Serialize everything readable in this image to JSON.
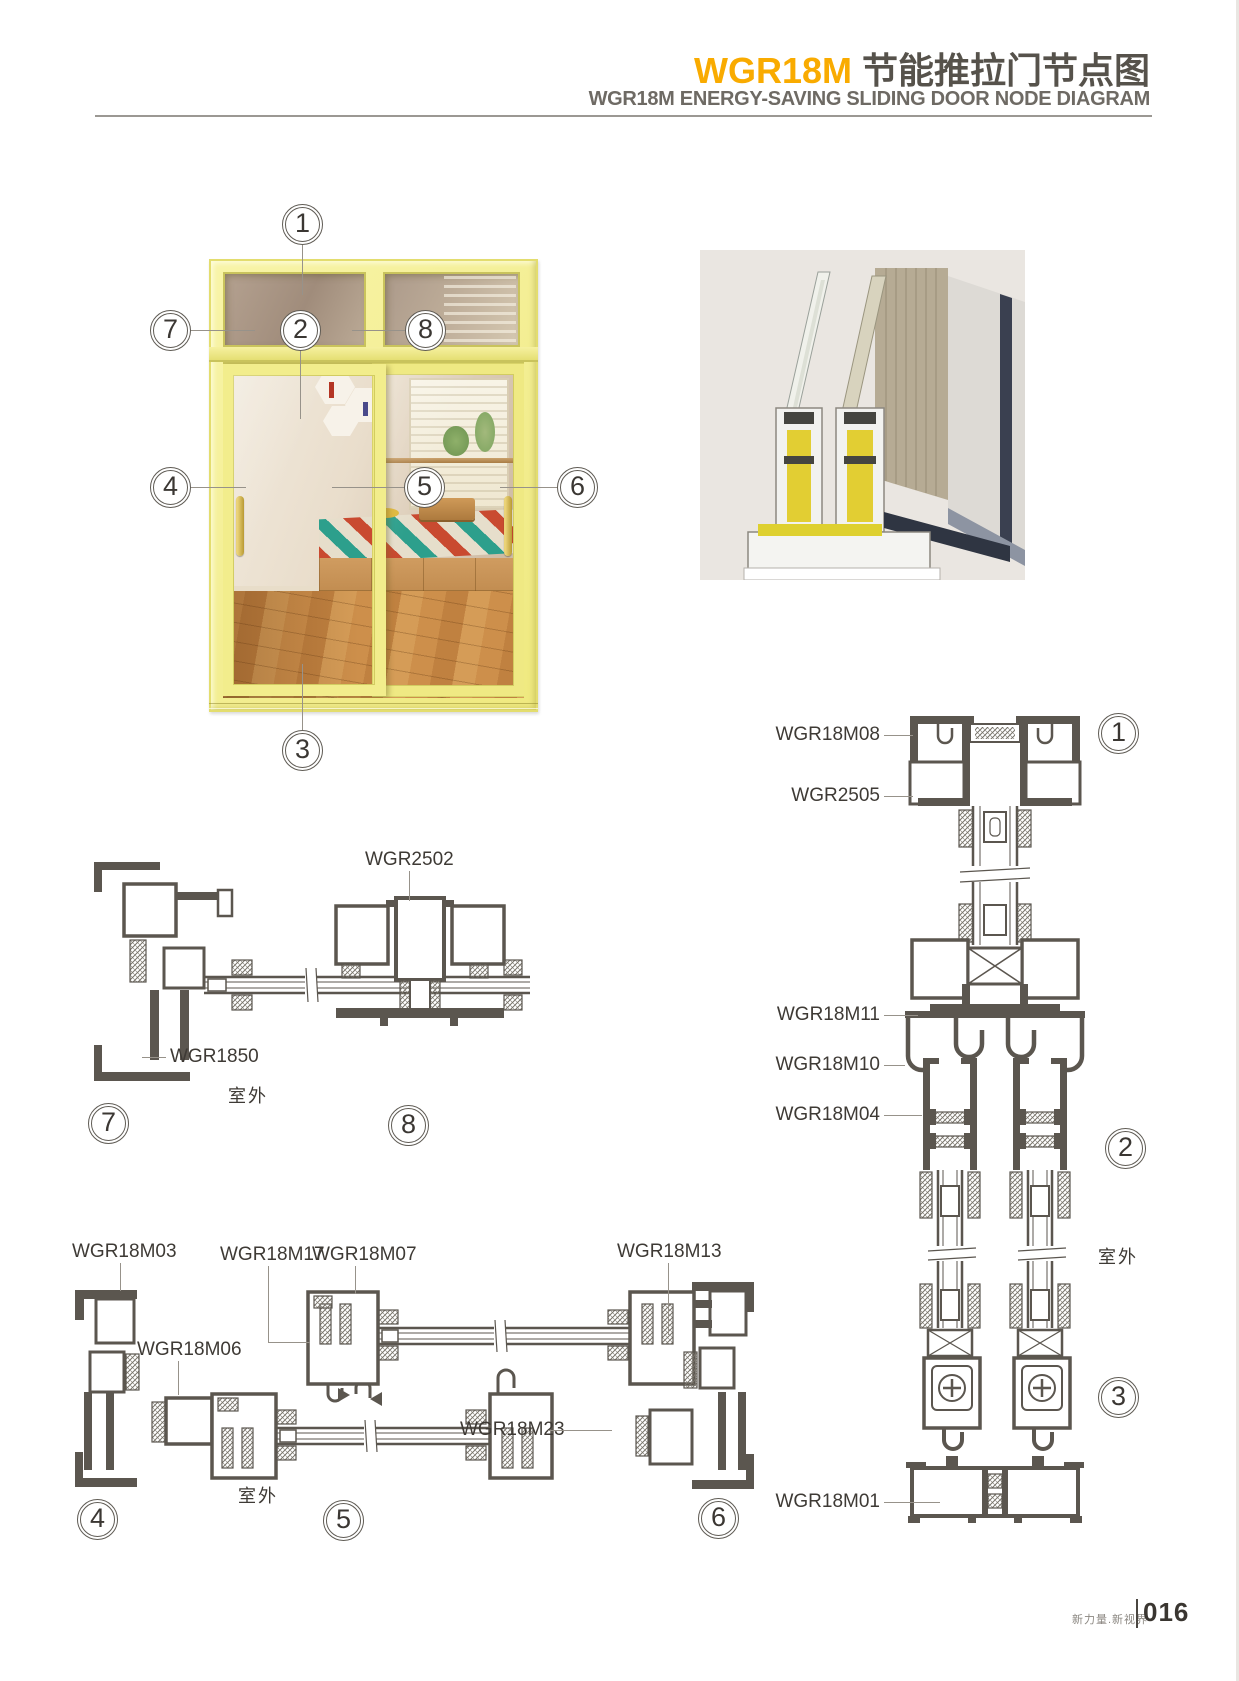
{
  "header": {
    "brand": "WGR18M",
    "title_cn": "节能推拉门节点图",
    "subtitle": "WGR18M ENERGY-SAVING SLIDING DOOR NODE DIAGRAM"
  },
  "overview": {
    "callouts": [
      "1",
      "2",
      "3",
      "4",
      "5",
      "6",
      "7",
      "8"
    ]
  },
  "section_a": {
    "callouts": [
      "7",
      "8"
    ],
    "outdoor": "室外",
    "labels": {
      "mullion": "WGR2502",
      "jamb": "WGR1850"
    }
  },
  "section_b": {
    "callouts": [
      "4",
      "5",
      "6"
    ],
    "outdoor": "室外",
    "labels": {
      "jamb_left": "WGR18M03",
      "interlock": "WGR18M17",
      "sash": "WGR18M07",
      "frame_right": "WGR18M13",
      "adapter": "WGR18M06",
      "connector": "WGR18M23"
    }
  },
  "section_c": {
    "callouts": [
      "1",
      "2",
      "3"
    ],
    "outdoor": "室外",
    "labels": {
      "head_frame": "WGR18M08",
      "glazing_bead": "WGR2505",
      "transom_sill": "WGR18M11",
      "hanging_track": "WGR18M10",
      "door_hanger": "WGR18M04",
      "bottom_track": "WGR18M01"
    }
  },
  "footer": {
    "slogan": "新力量.新视界",
    "page_no": "016"
  },
  "colors": {
    "accent": "#F9AB00",
    "heading_ink": "#56524B",
    "subtitle_gray": "#6E6A64",
    "drawing_ink": "#5B564F",
    "door_yellow": "#F2ED8C"
  }
}
